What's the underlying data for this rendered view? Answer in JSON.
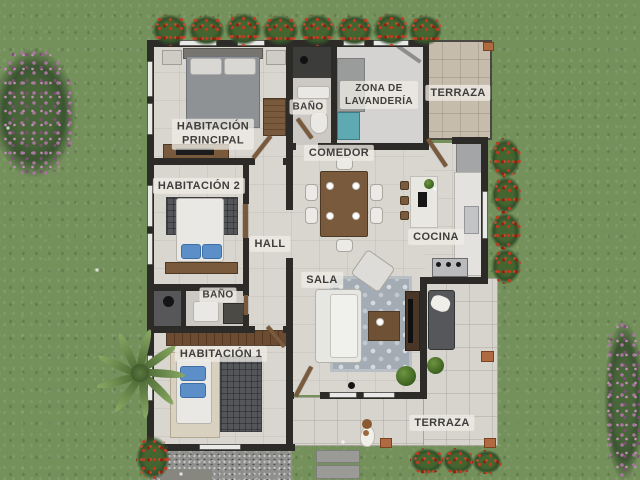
{
  "scene": {
    "type": "3d-floor-plan-top-view",
    "description": "Rendered top-down architectural floor plan of a house surrounded by grass, with two terraces, garden bushes, a palm tree and a dog on the terrace"
  },
  "palette": {
    "grass": "#74905b",
    "wall": "#2d2b28",
    "floor": "#d9d5cf",
    "terrace": "#d7d4ce",
    "terrace-top": "#c6bcab",
    "gravel": "#8f8f8d",
    "wood": "#7a5a3c",
    "rug-sala": "#a3acb4",
    "rug-dark": "#54565a",
    "washer": "#5fa9b2",
    "pillow-blue": "#5c8fc8",
    "flower-red": "#b33521",
    "flower-purple": "#9a6d92",
    "palm": "#8aa964",
    "label-ink": "#3f3e3c",
    "label-chip": "rgba(238,236,230,0.78)"
  },
  "labels": {
    "hab_principal": "HABITACIÓN\nPRINCIPAL",
    "bano_top": "BAÑO",
    "lavanderia": "ZONA DE\nLAVANDERÍA",
    "terraza_top": "TERRAZA",
    "hab_2": "HABITACIÓN 2",
    "hall": "HALL",
    "comedor": "COMEDOR",
    "cocina": "COCINA",
    "bano_lower": "BAÑO",
    "hab_1": "HABITACIÓN 1",
    "sala": "SALA",
    "terraza_bottom": "TERRAZA"
  }
}
